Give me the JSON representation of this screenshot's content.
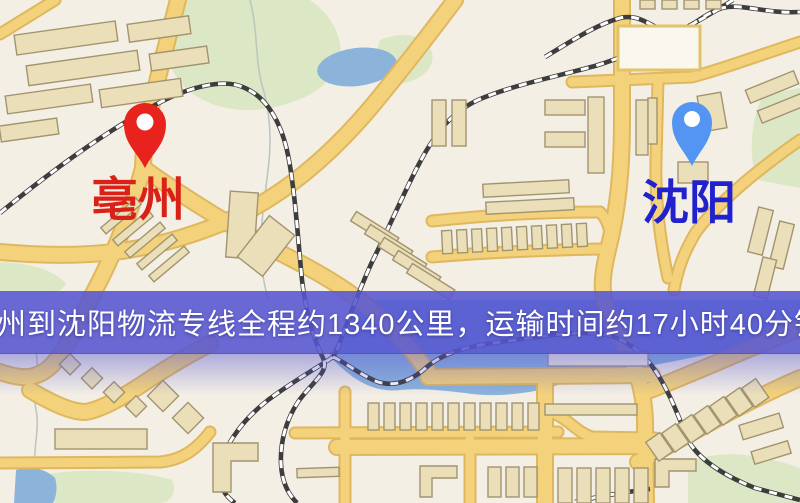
{
  "banner": {
    "text": "亳州到沈阳物流专线全程约1340公里，运输时间约17小时40分钟.",
    "background_color": "rgba(86,86,210,0.88)",
    "text_color": "#ffffff",
    "route": {
      "origin": "亳州",
      "destination": "沈阳",
      "distance": "约1340公里",
      "duration": "约17小时40分钟"
    }
  },
  "pins": [
    {
      "city": "亳州",
      "role": "origin",
      "pin_color": "#e8231d",
      "label_color": "#da2118"
    },
    {
      "city": "沈阳",
      "role": "destination",
      "pin_color": "#5494f2",
      "label_color": "#2121cd"
    }
  ],
  "map": {
    "palette": {
      "background": "#f4efe5",
      "road_fill": "#f3d27b",
      "road_casing": "#dfb75e",
      "building_fill": "#ebdfba",
      "building_stroke": "#a1946f",
      "green_area": "#dce8c5",
      "water": "#8cb3da",
      "railway_dark": "#3d3d3d",
      "railway_light": "#ffffff"
    }
  }
}
